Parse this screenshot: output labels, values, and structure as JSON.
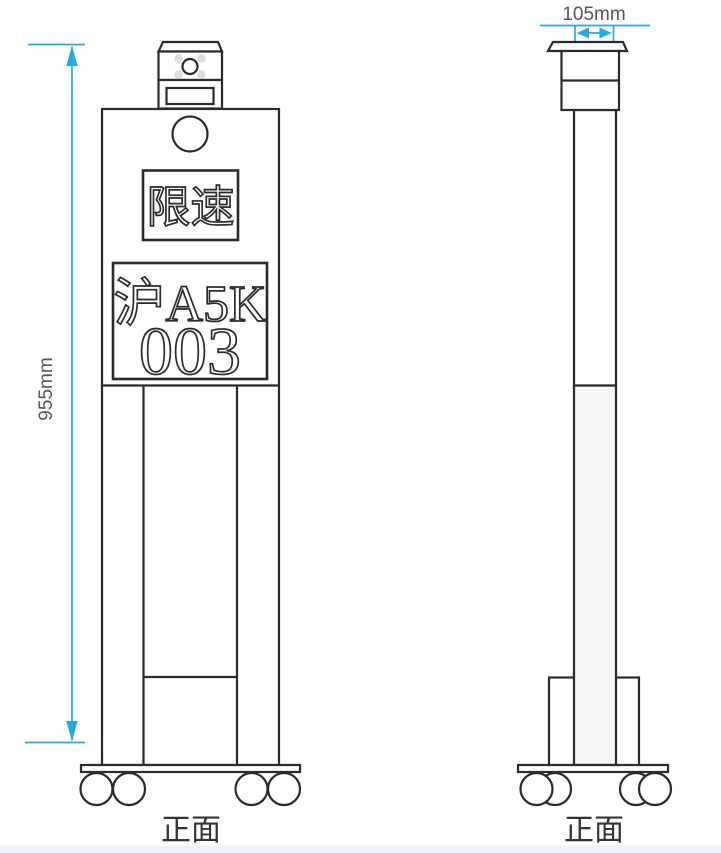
{
  "colors": {
    "accent": "#29A9E0",
    "line": "#2B2B2B",
    "dimtext": "#56575B",
    "labeltext": "#333333",
    "led": "#DCDCDC",
    "columnfill": "#F6F6F6",
    "strip": "#EDF2F8"
  },
  "front_view": {
    "label": "正面",
    "height_dimension": "955mm",
    "sign_text": "限速",
    "plate_line1": "沪A5K",
    "plate_line2": "003"
  },
  "side_view": {
    "label": "正面",
    "width_dimension": "105mm"
  }
}
